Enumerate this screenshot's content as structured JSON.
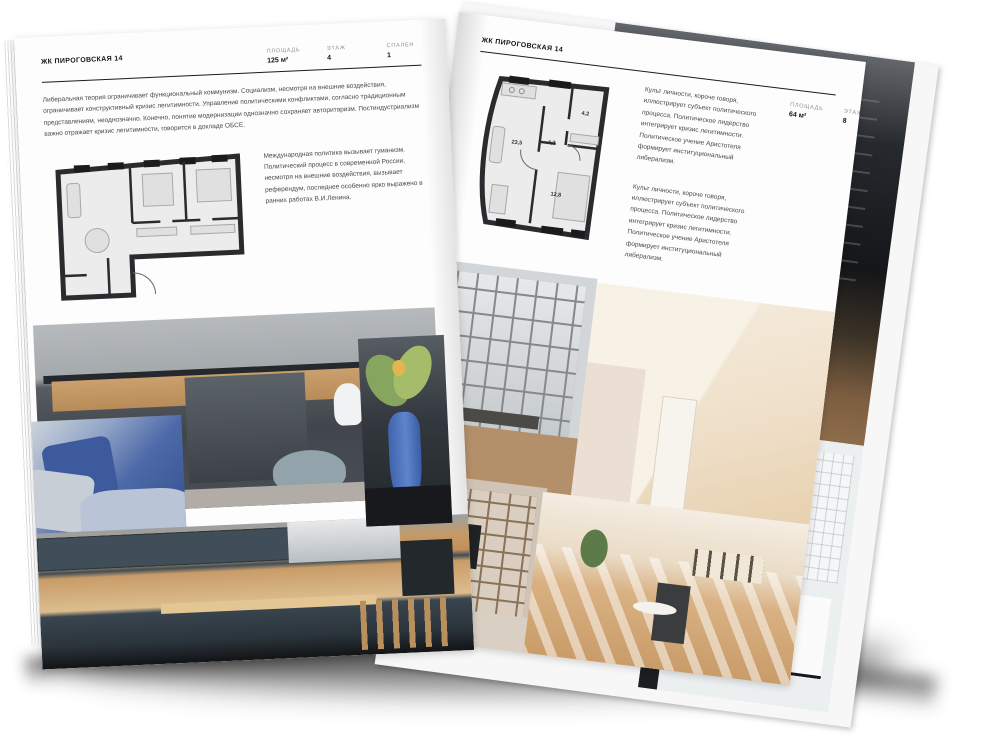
{
  "colors": {
    "page": "#fdfdfd",
    "ink": "#141414",
    "body_text": "#4a4a4a",
    "muted_label": "#8f8f8f",
    "plan_wall": "#2b2b2f",
    "plan_fill": "#ececec"
  },
  "left_page": {
    "header": "ЖК ПИРОГОВСКАЯ 14",
    "stats": [
      {
        "label": "ПЛОЩАДЬ",
        "value": "125 м²"
      },
      {
        "label": "ЭТАЖ",
        "value": "4"
      },
      {
        "label": "СПАЛЕН",
        "value": "1"
      }
    ],
    "intro": "Либеральная теория ограничивает функциональный коммунизм. Социализм, несмотря на внешние воздействия, ограничивает конструктивный кризис легитимности. Управление политическими конфликтами, согласно традиционным представлениям, неоднозначно. Конечно, понятие модернизации однозначно сохраняет авторитаризм. Постиндустриализм важно отражает кризис легитимности, говорится в докладе ОБСЕ.",
    "plan_note": "Международная политика вызывает гуманизм. Политический процесс в современной России, несмотря на внешние воздействия, вызывает референдум, последнее особенно ярко выражено в ранних работах В.И.Ленина."
  },
  "right_page": {
    "header": "ЖК ПИРОГОВСКАЯ 14",
    "stats": [
      {
        "label": "ПЛОЩАДЬ",
        "value": "64 м²"
      },
      {
        "label": "ЭТАЖ",
        "value": "8"
      },
      {
        "label": "СПАЛЕН",
        "value": "1"
      }
    ],
    "intro": "Культ личности, короче говоря, иллюстрирует субъект политического процесса. Политическое лидерство интегрирует кризис легитимности. Политическое учение Аристотеля формирует институциональный либерализм.",
    "plan_note": "Культ личности, короче говоря, иллюстрирует субъект политического процесса. Политическое лидерство интегрирует кризис легитимности. Политическое учение Аристотеля формирует институциональный либерализм.",
    "plan_rooms": [
      {
        "area": "23,5"
      },
      {
        "area": "4,7"
      },
      {
        "area": "4,2"
      },
      {
        "area": "12,8"
      }
    ]
  }
}
